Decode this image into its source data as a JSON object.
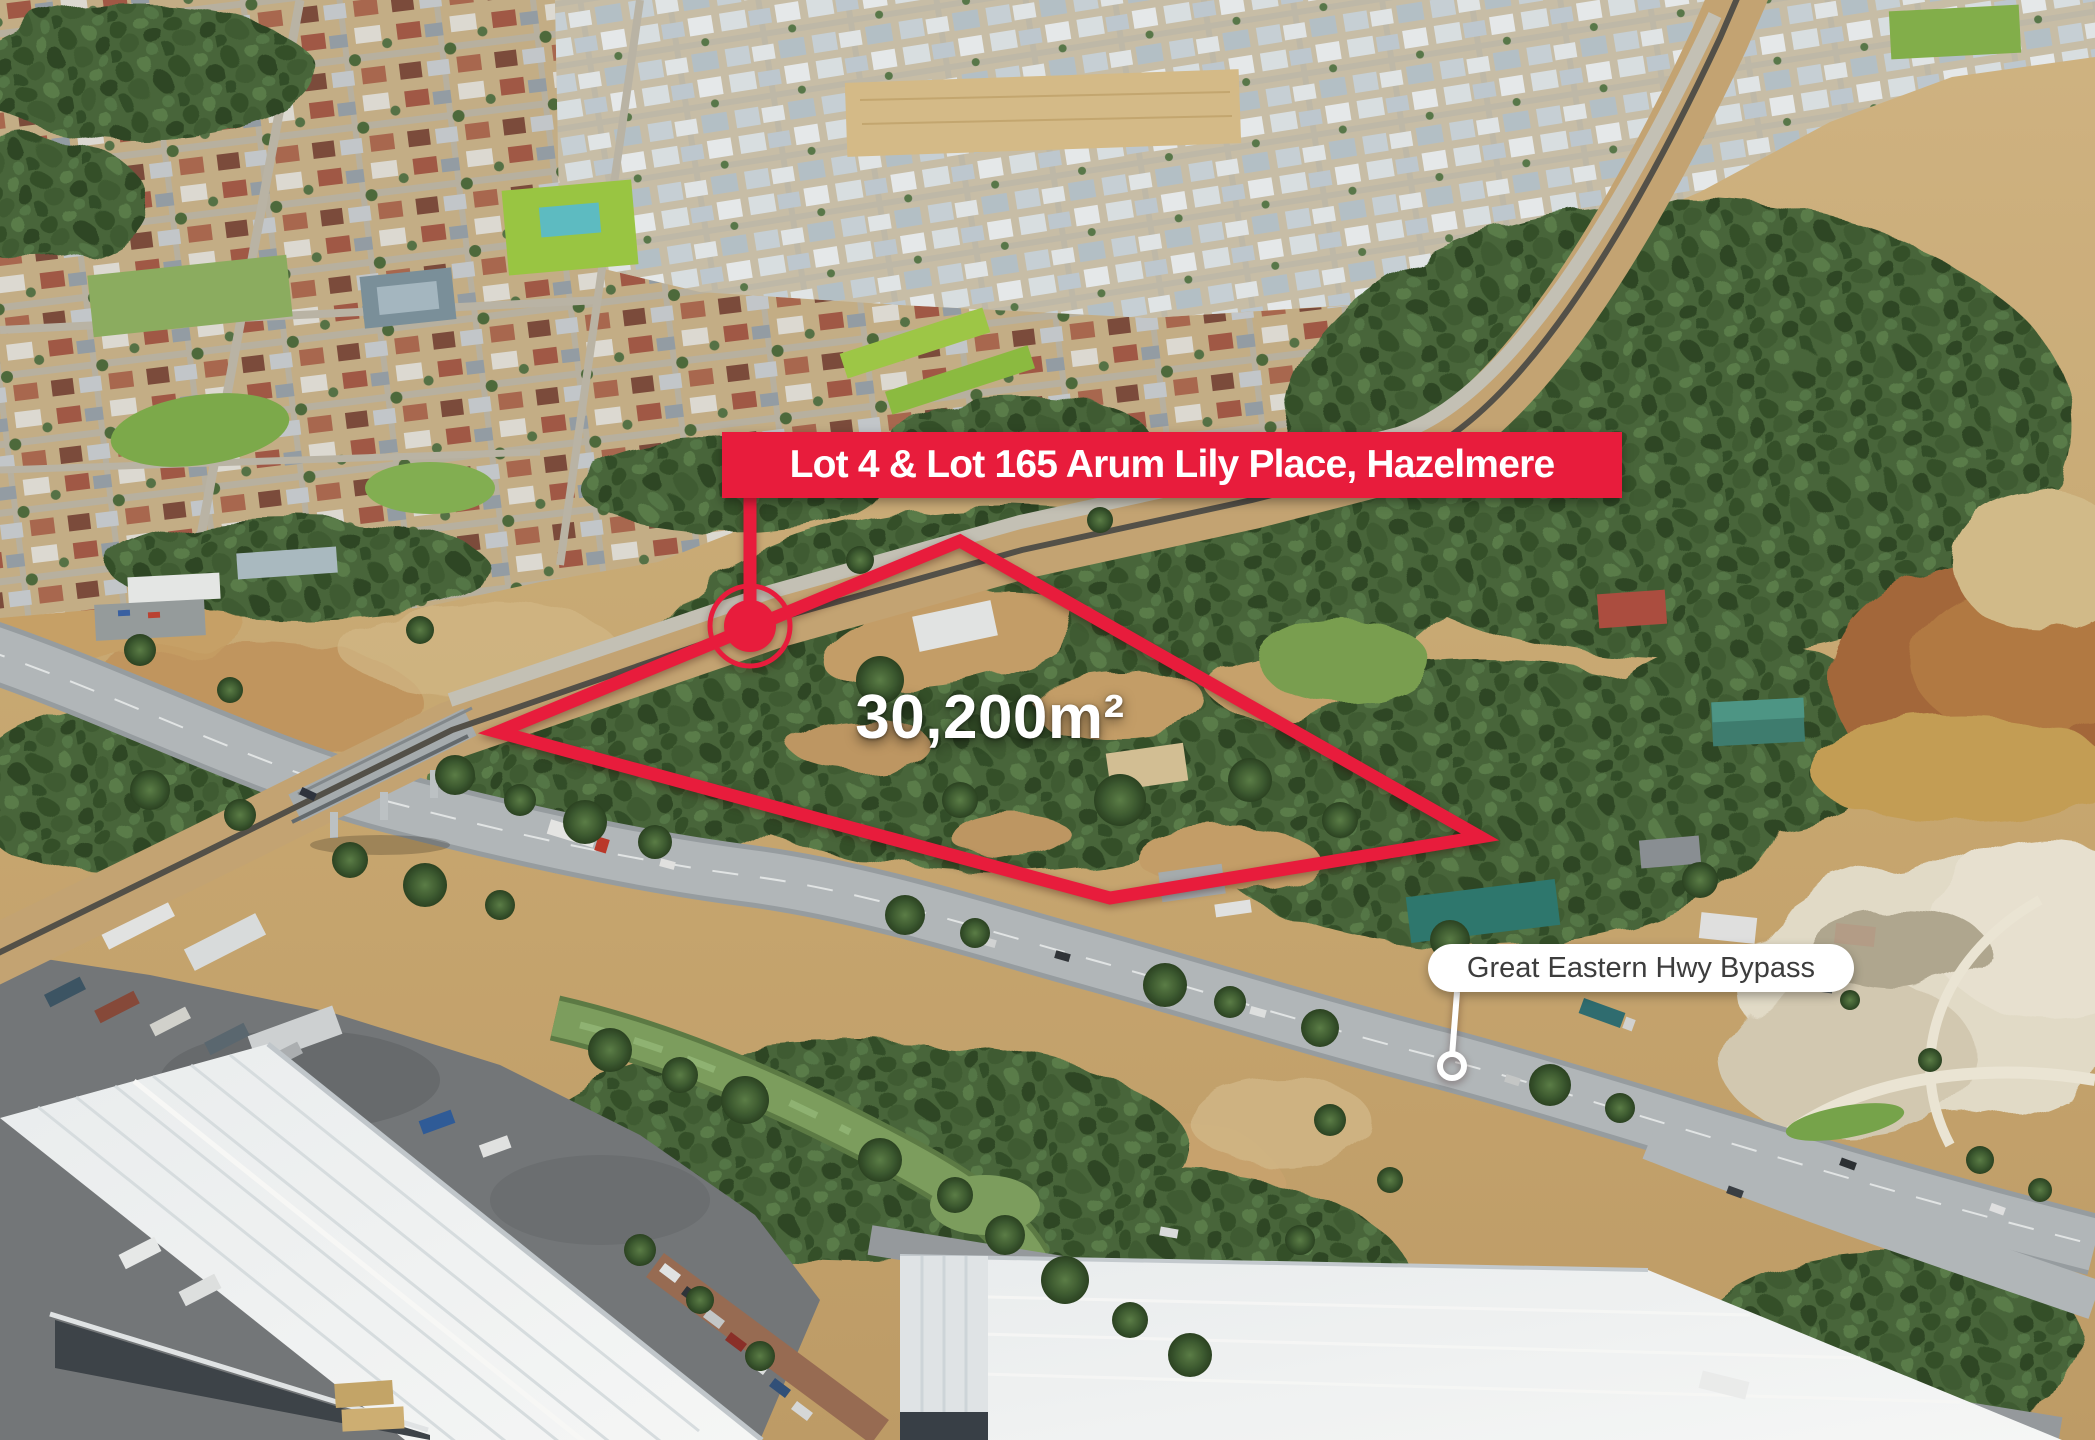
{
  "annotations": {
    "property_banner": "Lot 4 & Lot 165 Arum Lily Place, Hazelmere",
    "area_label": "30,200m²",
    "road_label": "Great Eastern Hwy Bypass"
  },
  "colors": {
    "accent_red": "#E81C3C",
    "banner_text": "#FFFFFF",
    "area_text": "#FFFFFF",
    "road_label_bg": "#FFFFFF",
    "road_label_text": "#3D3D3D"
  }
}
